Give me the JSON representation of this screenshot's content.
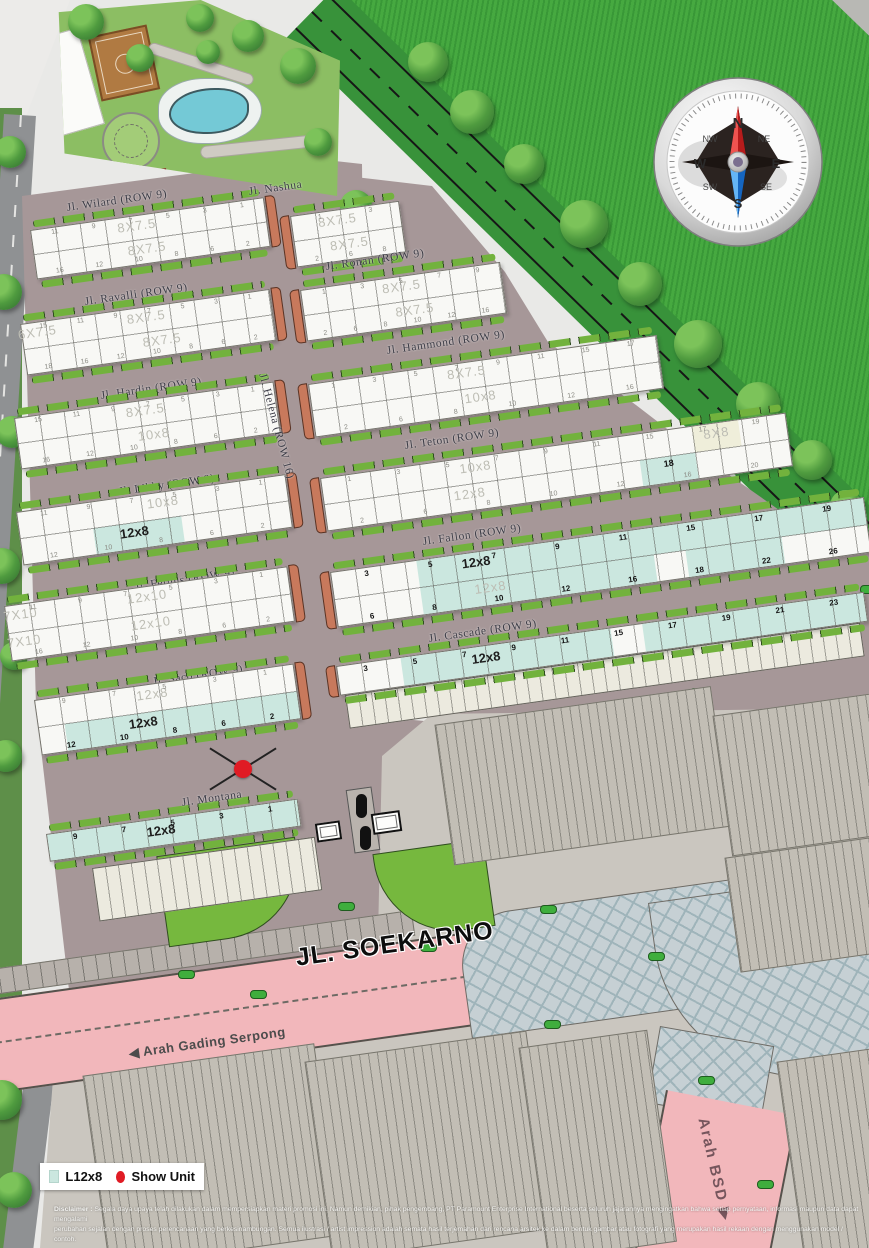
{
  "legend": {
    "swatch_label": "L12x8",
    "show_unit_label": "Show Unit",
    "swatch_color": "#cbe7df",
    "dot_color": "#e01b24"
  },
  "roads": {
    "soekarno": "JL. SOEKARNO"
  },
  "directions": {
    "gading_serpong": "◀ Arah Gading Serpong",
    "bsd": "Arah BSD ▶"
  },
  "compass": {
    "n": "N",
    "ne": "NE",
    "e": "E",
    "se": "SE",
    "s": "S",
    "sw": "SW",
    "w": "W",
    "nw": "NW"
  },
  "disclaimer": {
    "label": "Disclaimer :",
    "line1": "Segala daya upaya telah dilakukan dalam mempersiapkan materi promosi ini. Namun demikian, pihak pengembang, PT Paramount Enterprise International beserta seluruh jajarannya mengingatkan bahwa setiap pernyataan, informasi maupun data dapat mengalami",
    "line2": "perubahan sejalan dengan proses perencanaan yang berkesinambungan. Semua ilustrasi / artist impression adalah semata hasil terjemahan dari rencana arsitek ke dalam bentuk gambar atau fotografi yang merupakan hasil rekaan dengan menggunakan model / contoh."
  },
  "map": {
    "street_labels": [
      {
        "text": "Jl. Nashua",
        "x": 248,
        "y": 186,
        "rot": -8
      },
      {
        "text": "Jl. Montana",
        "x": 181,
        "y": 797,
        "rot": -8
      },
      {
        "text": "Jl. Helena (ROW 16)",
        "x": 268,
        "y": 372,
        "rot": 75
      }
    ],
    "rows": [
      {
        "id": "wilard",
        "label": "Jl. Wilard (ROW 9)",
        "lx": 66,
        "ly": 202,
        "x": 30,
        "y": 230,
        "w": 236,
        "h": 50,
        "cap": "right",
        "labels": [
          {
            "t": "8X7.5",
            "row": "top",
            "at": 0.45,
            "s": "gray"
          },
          {
            "t": "8X7.5",
            "row": "bot",
            "at": 0.48,
            "s": "gray"
          }
        ],
        "top": [
          "11",
          "9",
          "7",
          "5",
          "3",
          "1"
        ],
        "bot": [
          "16",
          "12",
          "10",
          "8",
          "6",
          "2"
        ],
        "ts": "gray",
        "bs": "gray"
      },
      {
        "id": "ravalli",
        "label": "Jl. Ravalli (ROW 9)",
        "lx": 84,
        "ly": 296,
        "x": 20,
        "y": 324,
        "w": 252,
        "h": 52,
        "cap": "right",
        "labels": [
          {
            "t": "6X7.5",
            "row": "top",
            "at": 0.06,
            "s": "gray"
          },
          {
            "t": "8X7.5",
            "row": "top",
            "at": 0.5,
            "s": "gray"
          },
          {
            "t": "8X7.5",
            "row": "bot",
            "at": 0.55,
            "s": "gray"
          }
        ],
        "top": [
          "15",
          "11",
          "9",
          "7",
          "5",
          "3",
          "1"
        ],
        "bot": [
          "18",
          "16",
          "12",
          "10",
          "8",
          "6",
          "2"
        ],
        "ts": "gray",
        "bs": "gray"
      },
      {
        "id": "hardin",
        "label": "Jl. Hardin (ROW 9)",
        "lx": 100,
        "ly": 390,
        "x": 14,
        "y": 418,
        "w": 262,
        "h": 52,
        "cap": "right",
        "labels": [
          {
            "t": "8X7.5",
            "row": "top",
            "at": 0.5,
            "s": "gray"
          },
          {
            "t": "10x8",
            "row": "bot",
            "at": 0.52,
            "s": "gray"
          }
        ],
        "top": [
          "15",
          "11",
          "9",
          "7",
          "5",
          "3",
          "1"
        ],
        "bot": [
          "16",
          "12",
          "10",
          "8",
          "6",
          "2"
        ],
        "ts": "gray",
        "bs": "gray"
      },
      {
        "id": "libby",
        "label": "Jl. Libby (ROW 9)",
        "lx": 118,
        "ly": 486,
        "x": 16,
        "y": 512,
        "w": 272,
        "h": 54,
        "cap": "right",
        "fills": [
          {
            "row": "bot",
            "from": 0.27,
            "to": 0.6,
            "c": "teal"
          }
        ],
        "labels": [
          {
            "t": "10x8",
            "row": "top",
            "at": 0.54,
            "s": "gray"
          },
          {
            "t": "12x8",
            "row": "bot",
            "at": 0.42,
            "s": "black"
          }
        ],
        "top": [
          "11",
          "9",
          "7",
          "5",
          "3",
          "1"
        ],
        "bot": [
          "12",
          "10",
          "8",
          "6",
          "2"
        ],
        "ts": "gray",
        "bs": "gray"
      },
      {
        "id": "fergus",
        "label": "Jl. Fergus (ROW 9)",
        "lx": 134,
        "ly": 581,
        "x": 4,
        "y": 606,
        "w": 286,
        "h": 56,
        "cap": "right",
        "labels": [
          {
            "t": "7X10",
            "row": "top",
            "at": 0.05,
            "s": "gray"
          },
          {
            "t": "12x10",
            "row": "top",
            "at": 0.5,
            "s": "gray"
          },
          {
            "t": "12x10",
            "row": "bot",
            "at": 0.5,
            "s": "gray"
          },
          {
            "t": "7X10",
            "row": "bot",
            "at": 0.05,
            "s": "gray"
          }
        ],
        "top": [
          "11",
          "9",
          "7",
          "5",
          "3",
          "1"
        ],
        "bot": [
          "16",
          "12",
          "10",
          "8",
          "6",
          "2"
        ],
        "ts": "gray",
        "bs": "gray"
      },
      {
        "id": "saco",
        "label": "Jl. Saco (ROW 9)",
        "lx": 152,
        "ly": 676,
        "x": 34,
        "y": 700,
        "w": 262,
        "h": 56,
        "cap": "right",
        "fills": [
          {
            "row": "bot",
            "from": 0.1,
            "to": 1,
            "c": "teal"
          }
        ],
        "labels": [
          {
            "t": "12x8",
            "row": "top",
            "at": 0.45,
            "s": "gray"
          },
          {
            "t": "12x8",
            "row": "bot",
            "at": 0.4,
            "s": "black"
          }
        ],
        "top": [
          "9",
          "7",
          "5",
          "3",
          "1"
        ],
        "bot": [
          "12",
          "10",
          "8",
          "6",
          "2"
        ],
        "ts": "gray",
        "bs": "bold"
      },
      {
        "id": "montana-row",
        "label": null,
        "x": 46,
        "y": 834,
        "w": 254,
        "h": 28,
        "single": true,
        "fills": [
          {
            "row": "top",
            "from": 0,
            "to": 1,
            "c": "teal"
          }
        ],
        "labels": [
          {
            "t": "12x8",
            "row": "top",
            "at": 0.45,
            "s": "black"
          }
        ],
        "top": [
          "9",
          "7",
          "5",
          "3",
          "1"
        ],
        "ts": "bold"
      },
      {
        "id": "nashua-block",
        "label": null,
        "x": 290,
        "y": 216,
        "w": 110,
        "h": 52,
        "cap": "left",
        "labels": [
          {
            "t": "8X7.5",
            "row": "top",
            "at": 0.42,
            "s": "gray"
          },
          {
            "t": "8X7.5",
            "row": "bot",
            "at": 0.5,
            "s": "gray"
          }
        ],
        "top": [
          "1",
          "3"
        ],
        "bot": [
          "2",
          "6",
          "8"
        ],
        "ts": "gray",
        "bs": "gray"
      },
      {
        "id": "ronan",
        "label": "Jl. Ronan (ROW 9)",
        "lx": 325,
        "ly": 261,
        "x": 300,
        "y": 290,
        "w": 202,
        "h": 52,
        "cap": "left",
        "labels": [
          {
            "t": "8X7.5",
            "row": "top",
            "at": 0.5,
            "s": "gray"
          },
          {
            "t": "8X7.5",
            "row": "bot",
            "at": 0.55,
            "s": "gray"
          }
        ],
        "top": [
          "1",
          "3",
          "5",
          "7",
          "9"
        ],
        "bot": [
          "2",
          "6",
          "8",
          "10",
          "12",
          "16"
        ],
        "ts": "gray",
        "bs": "gray"
      },
      {
        "id": "hammond",
        "label": "Jl. Hammond (ROW 9)",
        "lx": 386,
        "ly": 345,
        "x": 308,
        "y": 384,
        "w": 352,
        "h": 54,
        "cap": "left",
        "labels": [
          {
            "t": "8X7.5",
            "row": "top",
            "at": 0.45,
            "s": "gray"
          },
          {
            "t": "10x8",
            "row": "bot",
            "at": 0.48,
            "s": "gray"
          }
        ],
        "top": [
          "1",
          "3",
          "5",
          "7",
          "9",
          "11",
          "15",
          "17"
        ],
        "bot": [
          "2",
          "6",
          "8",
          "10",
          "12",
          "16"
        ],
        "ts": "gray",
        "bs": "gray"
      },
      {
        "id": "teton",
        "label": "Jl. Teton (ROW 9)",
        "lx": 404,
        "ly": 440,
        "x": 320,
        "y": 478,
        "w": 470,
        "h": 54,
        "cap": "left",
        "fills": [
          {
            "row": "top",
            "from": 0.8,
            "to": 0.9,
            "c": "cream"
          },
          {
            "row": "bot",
            "from": 0.68,
            "to": 0.8,
            "c": "teal"
          }
        ],
        "labels": [
          {
            "t": "10x8",
            "row": "top",
            "at": 0.33,
            "s": "gray"
          },
          {
            "t": "12x8",
            "row": "bot",
            "at": 0.31,
            "s": "gray"
          },
          {
            "t": "8X8",
            "row": "top",
            "at": 0.85,
            "s": "gray"
          },
          {
            "t": "18",
            "row": "bot",
            "at": 0.74,
            "s": "boldnum"
          }
        ],
        "top": [
          "1",
          "3",
          "5",
          "7",
          "9",
          "11",
          "15",
          "17",
          "19"
        ],
        "bot": [
          "2",
          "6",
          "8",
          "10",
          "12",
          "16",
          "20"
        ],
        "ts": "gray",
        "bs": "gray"
      },
      {
        "id": "fallon",
        "label": "Jl. Fallon (ROW 9)",
        "lx": 422,
        "ly": 536,
        "x": 330,
        "y": 572,
        "w": 539,
        "h": 56,
        "cap": "left",
        "fills": [
          {
            "row": "top",
            "from": 0.16,
            "to": 1,
            "c": "teal"
          },
          {
            "row": "bot",
            "from": 0.16,
            "to": 0.6,
            "c": "teal"
          },
          {
            "row": "bot",
            "from": 0.66,
            "to": 0.84,
            "c": "teal"
          }
        ],
        "labels": [
          {
            "t": "12x8",
            "row": "top",
            "at": 0.27,
            "s": "black"
          },
          {
            "t": "12x8",
            "row": "bot",
            "at": 0.29,
            "s": "gray"
          }
        ],
        "top": [
          "3",
          "5",
          "7",
          "9",
          "11",
          "15",
          "17",
          "19"
        ],
        "bot": [
          "6",
          "8",
          "10",
          "12",
          "16",
          "18",
          "22",
          "26"
        ],
        "ts": "bold",
        "bs": "bold"
      },
      {
        "id": "cascade",
        "label": "Jl. Cascade (ROW 9)",
        "lx": 428,
        "ly": 633,
        "x": 336,
        "y": 666,
        "w": 533,
        "h": 30,
        "single": true,
        "cap": "left",
        "fills": [
          {
            "row": "top",
            "from": 0.12,
            "to": 0.52,
            "c": "teal"
          },
          {
            "row": "top",
            "from": 0.58,
            "to": 1,
            "c": "teal"
          }
        ],
        "labels": [
          {
            "t": "12x8",
            "row": "top",
            "at": 0.28,
            "s": "black"
          }
        ],
        "top": [
          "3",
          "5",
          "7",
          "9",
          "11",
          "15",
          "17",
          "19",
          "21",
          "23"
        ],
        "ts": "bold"
      }
    ],
    "blocks": [
      {
        "x": 92,
        "y": 868,
        "w": 225,
        "h": 54,
        "t": "shop"
      },
      {
        "x": 345,
        "y": 695,
        "w": 520,
        "h": 34,
        "t": "shop"
      },
      {
        "x": 448,
        "y": 735,
        "w": 255,
        "h": 118,
        "t": "com"
      },
      {
        "x": 726,
        "y": 726,
        "w": 143,
        "h": 118,
        "t": "com"
      },
      {
        "x": 738,
        "y": 868,
        "w": 131,
        "h": 92,
        "t": "com"
      },
      {
        "x": 96,
        "y": 1086,
        "w": 210,
        "h": 170,
        "t": "com"
      },
      {
        "x": 318,
        "y": 1072,
        "w": 200,
        "h": 176,
        "t": "com"
      },
      {
        "x": 532,
        "y": 1058,
        "w": 106,
        "h": 190,
        "t": "com"
      },
      {
        "x": 790,
        "y": 1072,
        "w": 79,
        "h": 176,
        "t": "com"
      }
    ],
    "trees": [
      [
        428,
        62,
        20
      ],
      [
        472,
        112,
        22
      ],
      [
        524,
        164,
        20
      ],
      [
        584,
        224,
        24
      ],
      [
        640,
        284,
        22
      ],
      [
        698,
        344,
        24
      ],
      [
        758,
        404,
        22
      ],
      [
        812,
        460,
        20
      ],
      [
        846,
        506,
        16
      ],
      [
        356,
        206,
        16
      ],
      [
        298,
        66,
        18
      ],
      [
        248,
        36,
        16
      ],
      [
        86,
        22,
        18
      ],
      [
        318,
        142,
        14
      ],
      [
        200,
        18,
        14
      ],
      [
        140,
        58,
        14
      ],
      [
        208,
        52,
        12
      ],
      [
        10,
        152,
        16
      ],
      [
        4,
        292,
        18
      ],
      [
        12,
        432,
        16
      ],
      [
        2,
        566,
        18
      ],
      [
        14,
        656,
        14
      ],
      [
        6,
        756,
        16
      ],
      [
        2,
        1100,
        20
      ],
      [
        14,
        1190,
        18
      ]
    ],
    "bushes": [
      [
        178,
        970
      ],
      [
        420,
        943
      ],
      [
        544,
        1020
      ],
      [
        698,
        1076
      ],
      [
        757,
        1180
      ],
      [
        338,
        902
      ],
      [
        648,
        952
      ],
      [
        852,
        698
      ],
      [
        690,
        688
      ],
      [
        452,
        688
      ],
      [
        858,
        860
      ],
      [
        250,
        990
      ],
      [
        540,
        905
      ],
      [
        860,
        585
      ]
    ],
    "show_unit": {
      "x": 234,
      "y": 760
    }
  }
}
